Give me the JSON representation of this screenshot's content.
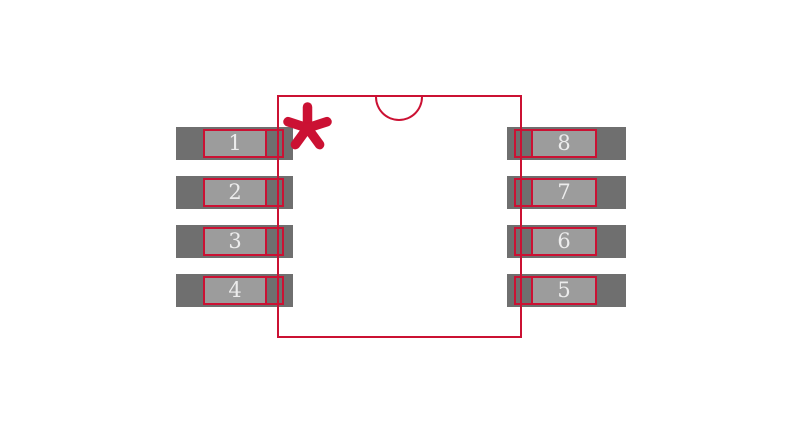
{
  "footprint": {
    "pins": {
      "left": [
        "1",
        "2",
        "3",
        "4"
      ],
      "right": [
        "8",
        "7",
        "6",
        "5"
      ]
    },
    "pin1_marker": "asterisk",
    "colors": {
      "outline_red": "#cb1133",
      "pad_dark_gray": "#6f6f6f",
      "pad_light_gray": "#9c9c9c",
      "pin_number_text": "#ececec",
      "background": "#ffffff"
    }
  }
}
